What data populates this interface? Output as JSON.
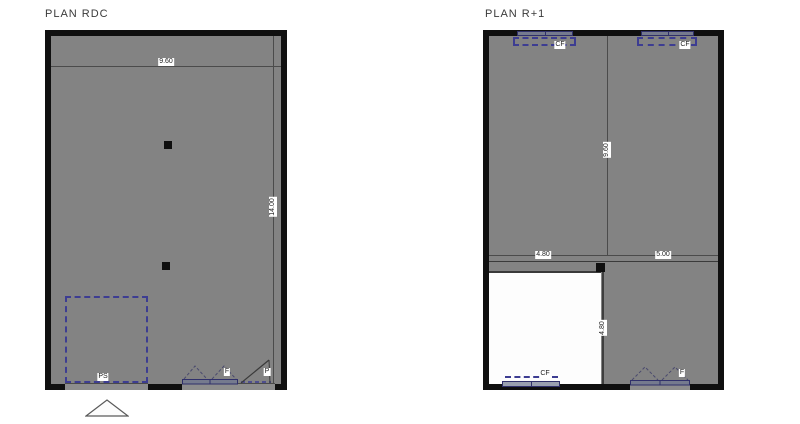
{
  "canvas": {
    "background": "#ffffff"
  },
  "colors": {
    "floor_fill": "#838383",
    "wall": "#101010",
    "interior_line": "#4b4b4b",
    "dashed_blue": "#3d3d92",
    "window_fill": "#757a8e",
    "white_zone": "#fdfdfd"
  },
  "plans": {
    "rdc": {
      "title": "PLAN RDC",
      "dim_width": "9.60",
      "dim_height": "14.00",
      "label_ps": "PS",
      "label_window": "F",
      "label_door": "P"
    },
    "r1": {
      "title": "PLAN R+1",
      "label_cf_left": "CF",
      "label_cf_right": "CF",
      "dim_height_upper": "9.60",
      "dim_width_left": "4.80",
      "dim_width_right": "5.00",
      "dim_height_lower": "4.80",
      "label_cf_bottom": "CF",
      "label_window": "F"
    }
  }
}
